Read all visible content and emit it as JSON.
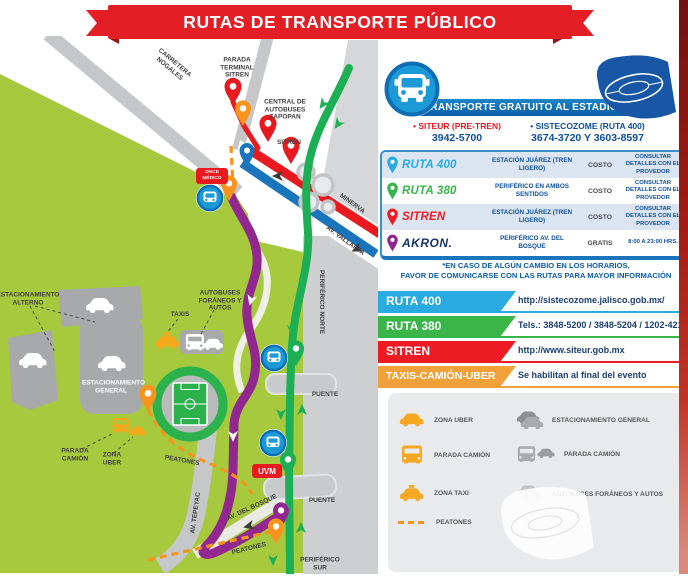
{
  "title": "RUTAS DE TRANSPORTE PÚBLICO",
  "panel": {
    "header": "TRANSPORTE GRATUITO AL ESTADIO",
    "contact_left_name": "• SITEUR (PRE-TREN)",
    "contact_left_phone": "3942-5700",
    "contact_right_name": "• SISTECOZOME (RUTA 400)",
    "contact_right_phone": "3674-3720 Y 3603-8597",
    "table_rows": [
      {
        "name": "RUTA 400",
        "station": "ESTACIÓN JUÁREZ (TREN LIGERO)",
        "cost": "COSTO",
        "details": "CONSULTAR DETALLES CON EL PROVEDOR",
        "pin_color": "#29abe2"
      },
      {
        "name": "RUTA 380",
        "station": "PERIFÉRICO EN AMBOS SENTIDOS",
        "cost": "COSTO",
        "details": "CONSULTAR DETALLES CON EL PROVEDOR",
        "pin_color": "#39b54a"
      },
      {
        "name": "SITREN",
        "station": "ESTACIÓN JUÁREZ (TREN LIGERO)",
        "cost": "COSTO",
        "details": "CONSULTAR DETALLES CON EL PROVEDOR",
        "pin_color": "#ed1c24"
      },
      {
        "name": "AKRON.",
        "station": "PERIFÉRICO AV. DEL BOSQUE",
        "cost": "GRATIS",
        "details": "8:00 A 23:00 HRS.",
        "pin_color": "#92278f"
      }
    ],
    "note1": "*EN CASO DE ALGÚN CAMBIO EN LOS HORARIOS,",
    "note2": "FAVOR DE COMUNICARSE CON LAS RUTAS PARA MAYOR INFORMACIÓN",
    "route_bars": [
      {
        "label": "RUTA 400",
        "value": "http://sistecozome.jalisco.gob.mx/",
        "color": "#29abe2"
      },
      {
        "label": "RUTA 380",
        "value": "Tels.: 3848-5200 / 3848-5204 / 1202-4214",
        "color": "#39b54a"
      },
      {
        "label": "SITREN",
        "value": "http://www.siteur.gob.mx",
        "color": "#ed1c24"
      },
      {
        "label": "TAXIS-CAMIÓN-UBER",
        "value": "Se habilitan al final del evento",
        "color": "#f0a13a"
      }
    ],
    "legend_left": [
      {
        "label": "ZONA UBER",
        "icon": "car-icon"
      },
      {
        "label": "PARADA CAMIÓN",
        "icon": "bus-icon"
      },
      {
        "label": "ZONA TAXI",
        "icon": "taxi-icon"
      }
    ],
    "legend_right": [
      {
        "label": "ESTACIONAMIENTO GENERAL",
        "icon": "cars-icon"
      },
      {
        "label": "PARADA CAMIÓN",
        "icon": "bus-car-icon"
      },
      {
        "label": "AUTOBUSES FORÁNEOS Y AUTOS",
        "icon": "buses-cars-icon"
      }
    ],
    "legend_peatones": "PEATONES"
  },
  "map": {
    "labels": [
      "CARRETERA NOGALES",
      "PARADA TERMINAL SITREN",
      "CENTRAL DE AUTOBUSES ZAPOPAN",
      "SITREN",
      "MINERVA",
      "AV. VALLARTA",
      "PERIFÉRICO NORTE",
      "ESTACIONAMIENTO ALTERNO",
      "TAXIS",
      "AUTOBUSES FORÁNEOS Y AUTOS",
      "ESTACIONAMIENTO GENERAL",
      "PARADA CAMIÓN",
      "ZONA UBER",
      "PEATONES",
      "AV. TEPEYAC",
      "AV. DEL BOSQUE",
      "PUENTE",
      "PUENTE",
      "PERIFÉRICO SUR",
      "PEATONES"
    ],
    "badges": {
      "uvm": "UVM",
      "medico": "ONCE MÉDICO"
    }
  },
  "colors": {
    "ruta400": "#29abe2",
    "ruta380": "#39b54a",
    "sitren": "#ed1c24",
    "akron_route": "#92278f",
    "peatones": "#f7941e",
    "panel_navy": "#0d4f9e",
    "map_green": "#a6c93e",
    "ribbon_red": "#e31e24"
  }
}
